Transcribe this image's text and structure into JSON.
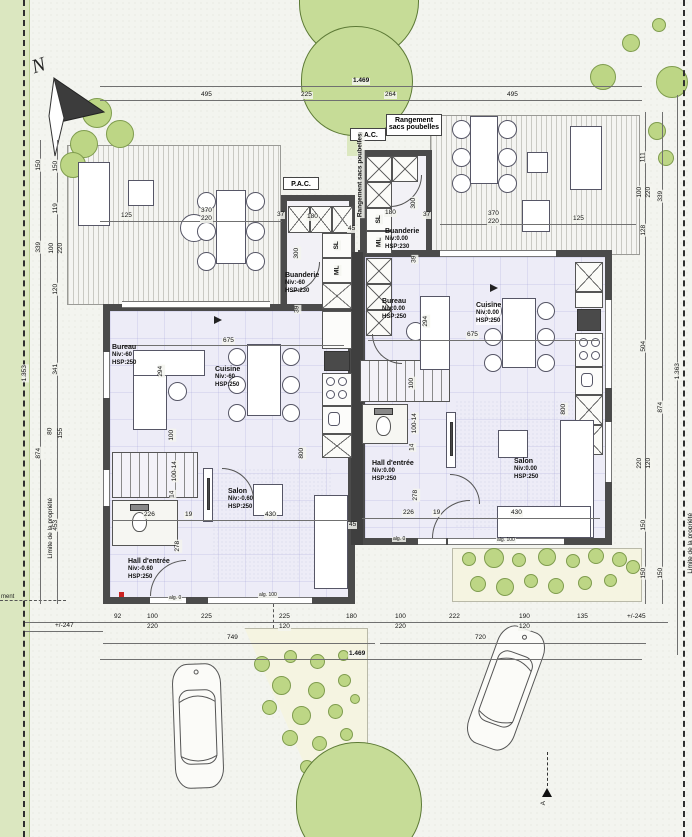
{
  "drawing": {
    "north_label": "N",
    "boundary_left": "Limite de la propriété",
    "boundary_right": "Limite de la propriété",
    "edge_note": "ment",
    "section_label": "A"
  },
  "labels": {
    "pac": "P.A.C.",
    "rangement_line1": "Rangement",
    "rangement_line2": "sacs poubelles",
    "sl": "SL",
    "ml": "ML",
    "alg0": "alg. 0",
    "alg100": "alg. 100"
  },
  "rooms": {
    "left": [
      {
        "name": "Bureau",
        "niv": "Niv:-60",
        "hsp": "HSP:250"
      },
      {
        "name": "Cuisine",
        "niv": "Niv:-60",
        "hsp": "HSP:250"
      },
      {
        "name": "Buanderie",
        "niv": "Niv:-60",
        "hsp": "HSP:230"
      },
      {
        "name": "Salon",
        "niv": "Niv:-0.60",
        "hsp": "HSP:250"
      },
      {
        "name": "Hall d'entrée",
        "niv": "Niv:-0.60",
        "hsp": "HSP:250"
      }
    ],
    "right": [
      {
        "name": "Buanderie",
        "niv": "Niv:0.00",
        "hsp": "HSP:230"
      },
      {
        "name": "Bureau",
        "niv": "Niv:0.00",
        "hsp": "HSP:250"
      },
      {
        "name": "Cuisine",
        "niv": "Niv:0.00",
        "hsp": "HSP:250"
      },
      {
        "name": "Salon",
        "niv": "Niv:0.00",
        "hsp": "HSP:250"
      },
      {
        "name": "Hall d'entrée",
        "niv": "Niv:0.00",
        "hsp": "HSP:250"
      }
    ]
  },
  "dims": {
    "top": [
      "1.469",
      "495",
      "225",
      "264",
      "495"
    ],
    "left_a": [
      "150",
      "339",
      "874"
    ],
    "left_b": [
      "150",
      "119",
      "100",
      "220",
      "120",
      "341",
      "80",
      "155",
      "453"
    ],
    "left_overall": "1.353",
    "left_offset": "+/-247",
    "right_a": [
      "111",
      "100",
      "220",
      "128",
      "504",
      "220",
      "120",
      "150",
      "150"
    ],
    "right_b": [
      "339",
      "874",
      "150"
    ],
    "right_overall": "1.363",
    "bottom_r1": [
      "92",
      "100",
      "220",
      "225",
      "225",
      "120",
      "180",
      "100",
      "220",
      "222",
      "190",
      "120",
      "135",
      "+/-245"
    ],
    "bottom_r2": [
      "749",
      "720"
    ],
    "bottom_overall": "1.469",
    "terrace": [
      "370",
      "220",
      "125"
    ],
    "int": [
      "675",
      "800",
      "294",
      "226",
      "19",
      "430",
      "278",
      "300",
      "180",
      "45",
      "37",
      "39",
      "100",
      "100-14",
      "14"
    ]
  }
}
